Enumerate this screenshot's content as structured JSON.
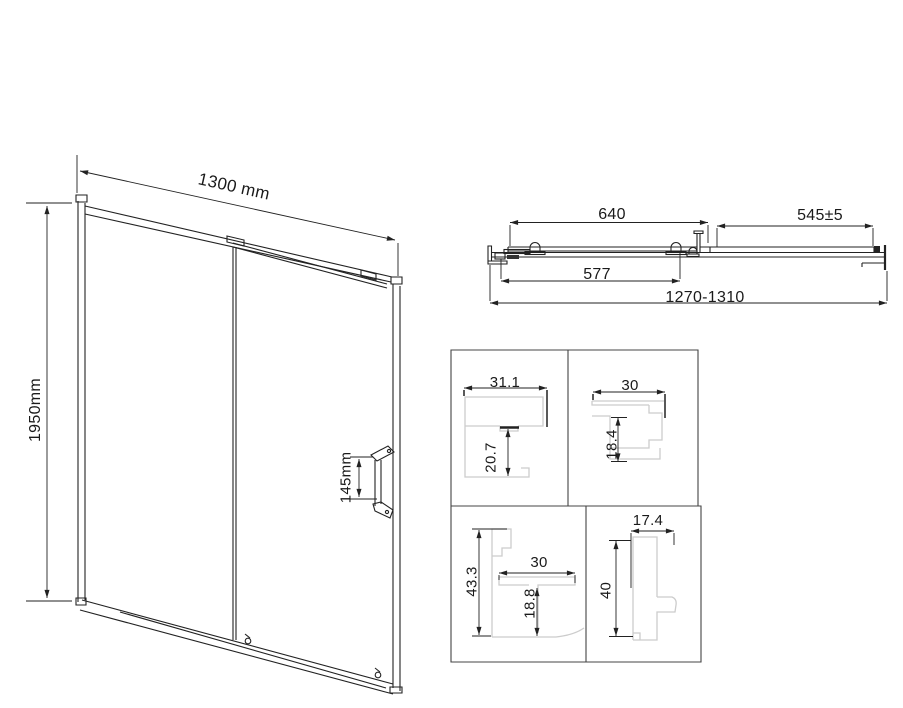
{
  "front_view": {
    "width_dim": "1300 mm",
    "height_dim": "1950mm",
    "handle_height_dim": "145mm"
  },
  "top_view": {
    "sliding_panel_dim": "640",
    "fixed_panel_dim": "545±5",
    "opening_width_dim": "577",
    "overall_width_range_dim": "1270-1310"
  },
  "profile_details": {
    "wall_profile": {
      "width_dim": "31.1",
      "depth_dim": "20.7"
    },
    "hook_profile": {
      "width_dim": "30",
      "depth_dim": "18.4"
    },
    "frame_profile": {
      "height_dim": "43.3",
      "width_dim": "30",
      "inner_depth_dim": "18.8"
    },
    "stile_profile": {
      "width_dim": "17.4",
      "height_dim": "40"
    }
  },
  "colors": {
    "line": "#222222",
    "profile_line": "#cccccc",
    "background": "#ffffff"
  }
}
